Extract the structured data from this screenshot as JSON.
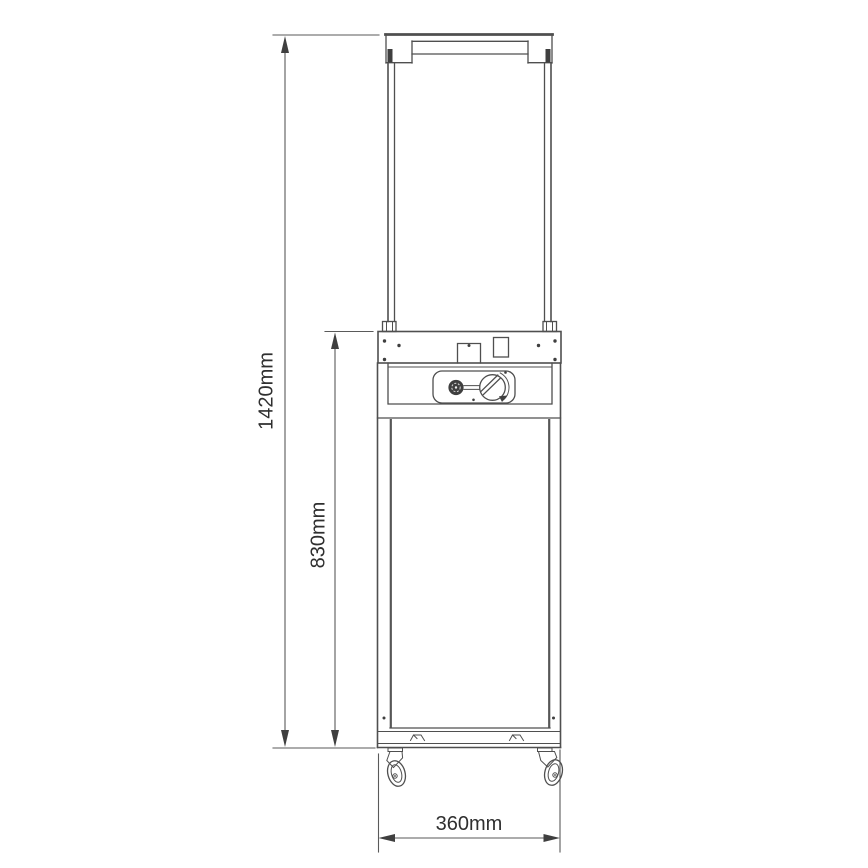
{
  "drawing": {
    "subject": "gas-patio-heater-front-elevation",
    "background_color": "#ffffff",
    "line_color": "#4f4f4f",
    "text_color": "#2f2f2f",
    "dimensions": {
      "total_height": {
        "label": "1420mm",
        "value_mm": 1420,
        "orientation": "vertical"
      },
      "body_height": {
        "label": "830mm",
        "value_mm": 830,
        "orientation": "vertical"
      },
      "width": {
        "label": "360mm",
        "value_mm": 360,
        "orientation": "horizontal"
      }
    }
  }
}
